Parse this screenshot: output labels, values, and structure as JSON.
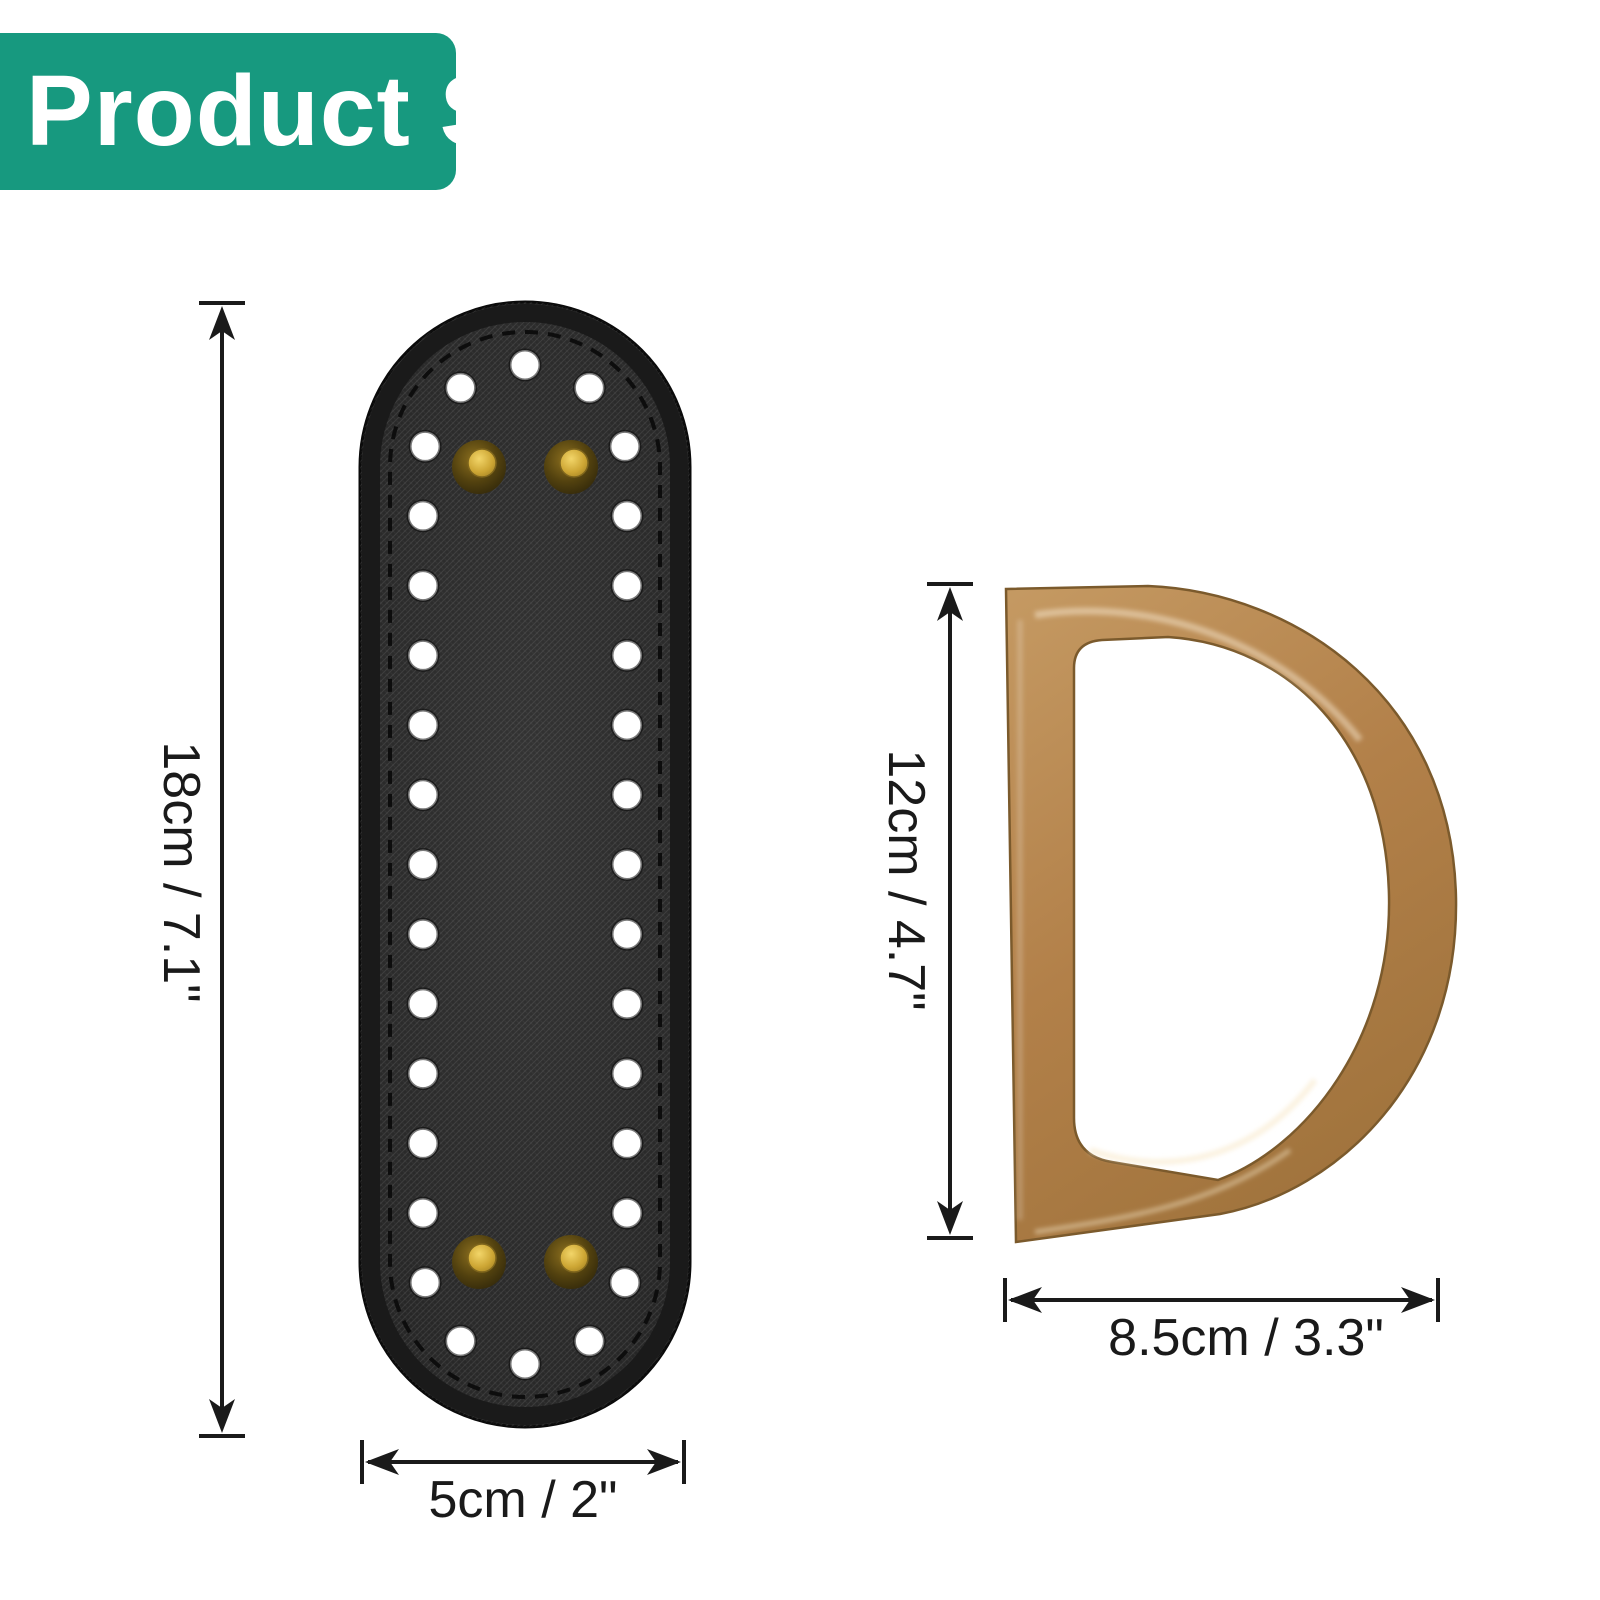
{
  "banner": {
    "label": "Product Size",
    "bg_color": "#17997f",
    "text_color": "#ffffff"
  },
  "annotation_color": "#1a1a1a",
  "items": [
    {
      "id": "bag-bottom-insert",
      "name": "oval-leather-bag-bottom-with-crochet-holes-and-rivets",
      "colors": {
        "leather": "#2a2a2a",
        "holes": "#ffffff",
        "rivets": "#c8a035",
        "stitching": "#0d0d0d"
      },
      "rivet_count": 4,
      "dimensions": {
        "height": "18cm / 7.1\"",
        "width": "5cm / 2\""
      }
    },
    {
      "id": "d-ring-handle",
      "name": "d-shaped-bag-handle",
      "colors": {
        "body": "#b28049"
      },
      "dimensions": {
        "height": "12cm / 4.7\"",
        "width": "8.5cm / 3.3\""
      }
    }
  ]
}
